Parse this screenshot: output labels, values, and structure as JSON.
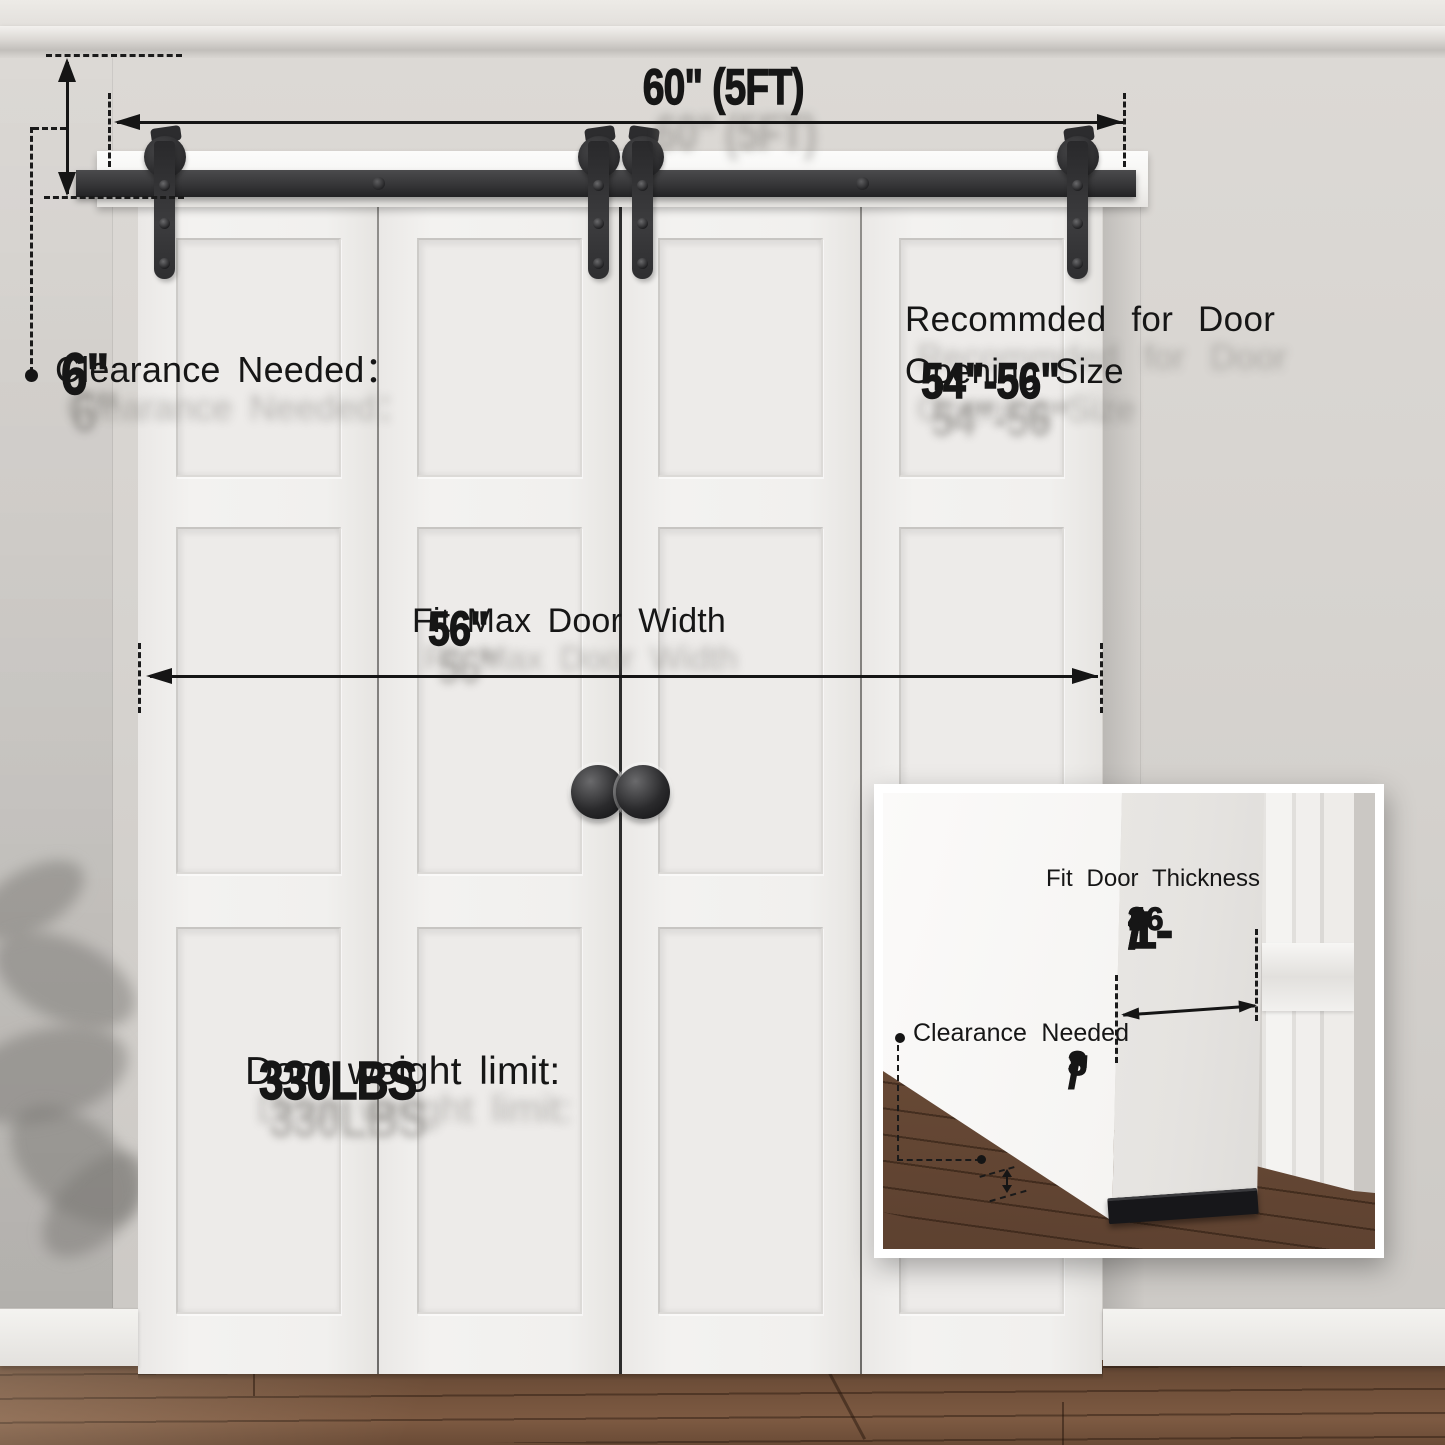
{
  "annotations": {
    "track_length": "60\" (5FT)",
    "clearance_label": "Clearance Needed：",
    "clearance_value": "6\"",
    "recommended_line1": "Recommded for Door",
    "recommended_line2_label": "Opening Size",
    "recommended_line2_value": "54\"-56\"",
    "max_width_label": "Fit Max Door Width",
    "max_width_value": "56\"",
    "weight_label": "Door weight limit:",
    "weight_value": "330LBS"
  },
  "inset": {
    "thickness_label": "Fit Door Thickness",
    "thickness_min_whole": "1-",
    "thickness_min_num": "3",
    "thickness_min_den": "16",
    "thickness_min_unit": "\"",
    "thickness_separator": "~",
    "thickness_max_whole": "1-",
    "thickness_max_num": "3",
    "thickness_max_den": "4",
    "thickness_max_unit": "\"",
    "clearance_label": "Clearance Needed",
    "clearance_num": "3",
    "clearance_den": "8",
    "clearance_unit": "\""
  },
  "colors": {
    "text": "#161616",
    "hardware_black": "#2e2e30",
    "wall": "#d6d3cf",
    "door_white": "#f1f0ee",
    "floor_brown": "#6e4f38"
  }
}
